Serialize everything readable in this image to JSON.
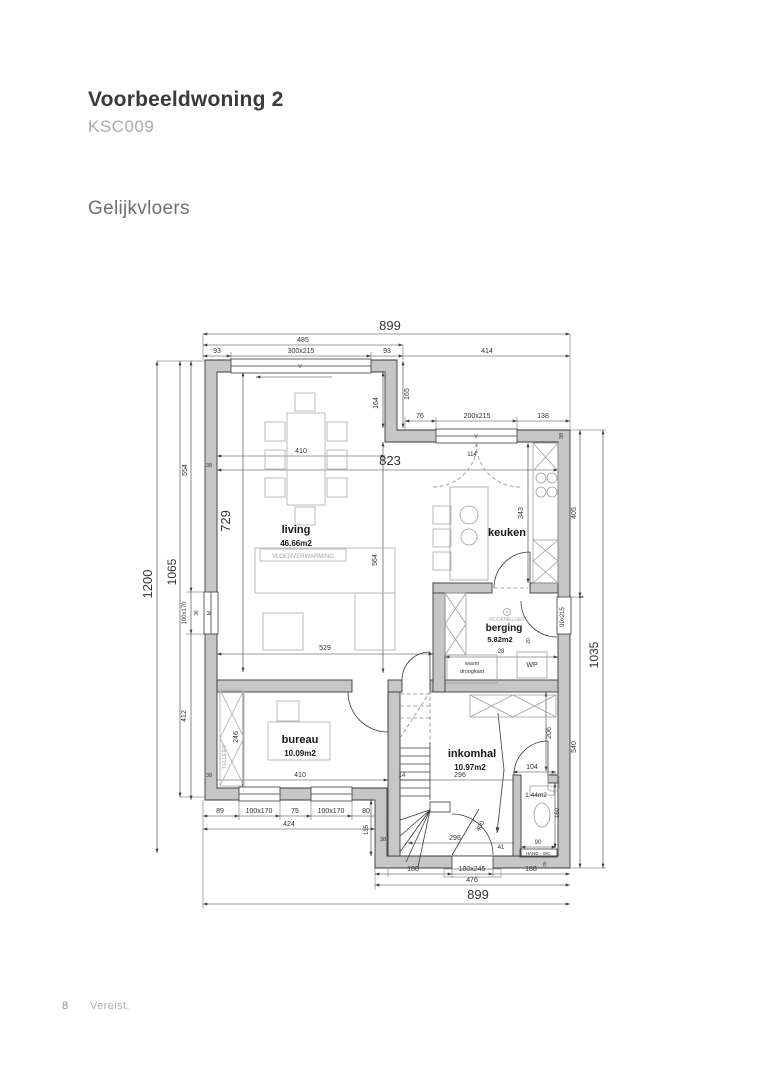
{
  "header": {
    "title": "Voorbeeldwoning 2",
    "code": "KSC009",
    "section": "Gelijkvloers"
  },
  "footer": {
    "page_number": "8",
    "note": "Vereist."
  },
  "plan": {
    "rooms": [
      {
        "name": "living",
        "area": "46.66m2"
      },
      {
        "name": "keuken",
        "area": ""
      },
      {
        "name": "berging",
        "area": "5.82m2"
      },
      {
        "name": "bureau",
        "area": "10.09m2"
      },
      {
        "name": "inkomhal",
        "area": "10.97m2"
      },
      {
        "name": "wc",
        "area": "1.44m2"
      }
    ],
    "labels": [
      {
        "t": "899",
        "x": 390,
        "y": 330,
        "s": 13
      },
      {
        "t": "485",
        "x": 303,
        "y": 342,
        "s": 7
      },
      {
        "t": "93",
        "x": 217,
        "y": 353,
        "s": 7
      },
      {
        "t": "300x215",
        "x": 301,
        "y": 353,
        "s": 7
      },
      {
        "t": "93",
        "x": 387,
        "y": 353,
        "s": 7
      },
      {
        "t": "414",
        "x": 487,
        "y": 353,
        "s": 7
      },
      {
        "t": "165",
        "x": 409,
        "y": 394,
        "s": 7,
        "r": -90
      },
      {
        "t": "164",
        "x": 378,
        "y": 403,
        "s": 7,
        "r": -90
      },
      {
        "t": "76",
        "x": 420,
        "y": 418,
        "s": 7
      },
      {
        "t": "200x215",
        "x": 477,
        "y": 418,
        "s": 7
      },
      {
        "t": "138",
        "x": 543,
        "y": 418,
        "s": 7
      },
      {
        "t": "410",
        "x": 301,
        "y": 453,
        "s": 7
      },
      {
        "t": "823",
        "x": 390,
        "y": 465,
        "s": 13
      },
      {
        "t": "114",
        "x": 472,
        "y": 456,
        "s": 6
      },
      {
        "t": "38",
        "x": 209,
        "y": 467,
        "s": 5.5
      },
      {
        "t": "38",
        "x": 563,
        "y": 436,
        "s": 5.5,
        "r": -90
      },
      {
        "t": "1200",
        "x": 152,
        "y": 584,
        "s": 13,
        "r": -90
      },
      {
        "t": "1065",
        "x": 176,
        "y": 572,
        "s": 12,
        "r": -90
      },
      {
        "t": "554",
        "x": 187,
        "y": 470,
        "s": 7,
        "r": -90
      },
      {
        "t": "729",
        "x": 230,
        "y": 521,
        "s": 13,
        "r": -90
      },
      {
        "t": "100x170",
        "x": 186,
        "y": 613,
        "s": 6,
        "r": -90
      },
      {
        "t": "36",
        "x": 198,
        "y": 613,
        "s": 5,
        "r": -90
      },
      {
        "t": "M",
        "x": 211,
        "y": 613,
        "s": 5,
        "r": -90
      },
      {
        "t": "412",
        "x": 186,
        "y": 716,
        "s": 7,
        "r": -90
      },
      {
        "t": "246",
        "x": 238,
        "y": 737,
        "s": 7,
        "r": -90
      },
      {
        "t": "living",
        "x": 296,
        "y": 533,
        "s": 11,
        "c": "room"
      },
      {
        "t": "46.66m2",
        "x": 296,
        "y": 546,
        "s": 8,
        "c": "room"
      },
      {
        "t": "VLOERVERWARMING",
        "x": 303,
        "y": 558,
        "s": 6,
        "c": "gray"
      },
      {
        "t": "564",
        "x": 377,
        "y": 560,
        "s": 7,
        "r": -90
      },
      {
        "t": "529",
        "x": 325,
        "y": 650,
        "s": 7
      },
      {
        "t": "keuken",
        "x": 507,
        "y": 536,
        "s": 11,
        "c": "room"
      },
      {
        "t": "343",
        "x": 523,
        "y": 513,
        "s": 7,
        "r": -90
      },
      {
        "t": "405",
        "x": 576,
        "y": 513,
        "s": 7,
        "r": -90
      },
      {
        "t": "1035",
        "x": 598,
        "y": 655,
        "s": 12,
        "r": -90
      },
      {
        "t": "5",
        "x": 583,
        "y": 597,
        "s": 5,
        "r": -90
      },
      {
        "t": "berging",
        "x": 504,
        "y": 631,
        "s": 10,
        "c": "room"
      },
      {
        "t": "5.82m2",
        "x": 500,
        "y": 642,
        "s": 7.5,
        "c": "room"
      },
      {
        "t": "ROOKMELDER",
        "x": 507,
        "y": 621,
        "s": 5,
        "c": "gray"
      },
      {
        "t": "20",
        "x": 530,
        "y": 641,
        "s": 5,
        "r": -90
      },
      {
        "t": "28",
        "x": 501,
        "y": 653,
        "s": 6
      },
      {
        "t": "wasm",
        "x": 472,
        "y": 665,
        "s": 5.5
      },
      {
        "t": "droogkast",
        "x": 472,
        "y": 673,
        "s": 5.5
      },
      {
        "t": "WP",
        "x": 532,
        "y": 667,
        "s": 7
      },
      {
        "t": "90x215",
        "x": 564,
        "y": 617,
        "s": 6,
        "r": -90
      },
      {
        "t": "206",
        "x": 551,
        "y": 733,
        "s": 7,
        "r": -90
      },
      {
        "t": "540",
        "x": 576,
        "y": 747,
        "s": 7,
        "r": -90
      },
      {
        "t": "bureau",
        "x": 300,
        "y": 743,
        "s": 11,
        "c": "room"
      },
      {
        "t": "10.09m2",
        "x": 300,
        "y": 756,
        "s": 8,
        "c": "room"
      },
      {
        "t": "TELLERS",
        "x": 226,
        "y": 757,
        "s": 5.5,
        "r": -90,
        "c": "gray"
      },
      {
        "t": "38",
        "x": 209,
        "y": 777,
        "s": 5.5
      },
      {
        "t": "410",
        "x": 300,
        "y": 777,
        "s": 7
      },
      {
        "t": "14",
        "x": 402,
        "y": 777,
        "s": 6
      },
      {
        "t": "296",
        "x": 460,
        "y": 777,
        "s": 7
      },
      {
        "t": "inkomhal",
        "x": 472,
        "y": 757,
        "s": 11,
        "c": "room"
      },
      {
        "t": "10.97m2",
        "x": 470,
        "y": 770,
        "s": 8,
        "c": "room"
      },
      {
        "t": "104",
        "x": 532,
        "y": 769,
        "s": 7
      },
      {
        "t": "1.44m2",
        "x": 536,
        "y": 797,
        "s": 6.5
      },
      {
        "t": "160",
        "x": 559,
        "y": 813,
        "s": 6,
        "r": -90
      },
      {
        "t": "296",
        "x": 455,
        "y": 840,
        "s": 7
      },
      {
        "t": "400",
        "x": 482,
        "y": 827,
        "s": 6.5,
        "r": -62
      },
      {
        "t": "41",
        "x": 501,
        "y": 849,
        "s": 6
      },
      {
        "t": "90",
        "x": 538,
        "y": 844,
        "s": 6
      },
      {
        "t": "HANG - WC",
        "x": 538,
        "y": 855,
        "s": 4.5
      },
      {
        "t": "25",
        "x": 546,
        "y": 864,
        "s": 4.5,
        "r": -90
      },
      {
        "t": "135",
        "x": 368,
        "y": 830,
        "s": 6,
        "r": -90
      },
      {
        "t": "38",
        "x": 383,
        "y": 841,
        "s": 5.5
      },
      {
        "t": "89",
        "x": 220,
        "y": 813,
        "s": 7
      },
      {
        "t": "100x170",
        "x": 259,
        "y": 813,
        "s": 7
      },
      {
        "t": "75",
        "x": 295,
        "y": 813,
        "s": 7
      },
      {
        "t": "100x170",
        "x": 331,
        "y": 813,
        "s": 7
      },
      {
        "t": "80",
        "x": 366,
        "y": 813,
        "s": 7
      },
      {
        "t": "424",
        "x": 289,
        "y": 826,
        "s": 7
      },
      {
        "t": "188",
        "x": 413,
        "y": 871,
        "s": 7
      },
      {
        "t": "100x245",
        "x": 472,
        "y": 871,
        "s": 7
      },
      {
        "t": "188",
        "x": 531,
        "y": 871,
        "s": 7
      },
      {
        "t": "476",
        "x": 472,
        "y": 882,
        "s": 7
      },
      {
        "t": "899",
        "x": 478,
        "y": 899,
        "s": 13
      },
      {
        "t": "V",
        "x": 300,
        "y": 368,
        "s": 5
      },
      {
        "t": "V",
        "x": 476,
        "y": 438,
        "s": 5
      }
    ]
  }
}
